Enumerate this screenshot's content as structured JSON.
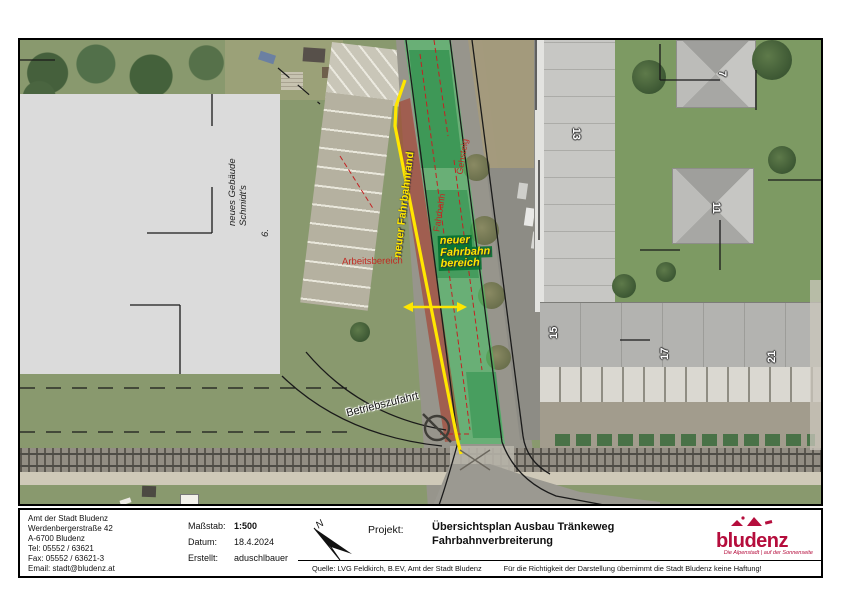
{
  "map": {
    "labels": {
      "fahrbahnrand": "neuer Fahrbahnrand",
      "bereich_line1": "neuer",
      "bereich_line2": "Fahrbahn",
      "bereich_line3": "bereich",
      "arbeitsbereich": "Arbeitsbereich",
      "fahrbahn": "Fahrbahn",
      "gehsteig": "Gehsteig",
      "betriebszufahrt": "Betriebszufahrt",
      "gebaeude_line1": "neues Gebäude",
      "gebaeude_line2": "Schmidt's",
      "gebaeude_nr": "6."
    },
    "house_numbers": [
      "7",
      "13",
      "11",
      "15",
      "17",
      "21"
    ],
    "colors": {
      "highlight_yellow": "#ffe600",
      "overlay_green": "#37cd5f",
      "overlay_red": "#a8321f",
      "annotation_red": "#c22a22"
    }
  },
  "titleblock": {
    "address": [
      "Amt der Stadt Bludenz",
      "Werdenbergerstraße 42",
      "A-6700 Bludenz",
      "Tel: 05552 / 63621",
      "Fax: 05552 / 63621-3",
      "Email: stadt@bludenz.at"
    ],
    "massstab_label": "Maßstab:",
    "massstab_value": "1:500",
    "datum_label": "Datum:",
    "datum_value": "18.4.2024",
    "erstellt_label": "Erstellt:",
    "erstellt_value": "aduschlbauer",
    "projekt_label": "Projekt:",
    "projekt_title_line1": "Übersichtsplan Ausbau Tränkeweg",
    "projekt_title_line2": "Fahrbahnverbreiterung",
    "quelle": "Quelle: LVG Feldkirch, B.EV, Amt der Stadt Bludenz",
    "disclaimer": "Für die Richtigkeit der Darstellung übernimmt die Stadt Bludenz keine Haftung!",
    "logo_text": "bludenz",
    "logo_tagline": "Die Alpenstadt | auf der Sonnenseite",
    "logo_color": "#b50d3c"
  }
}
